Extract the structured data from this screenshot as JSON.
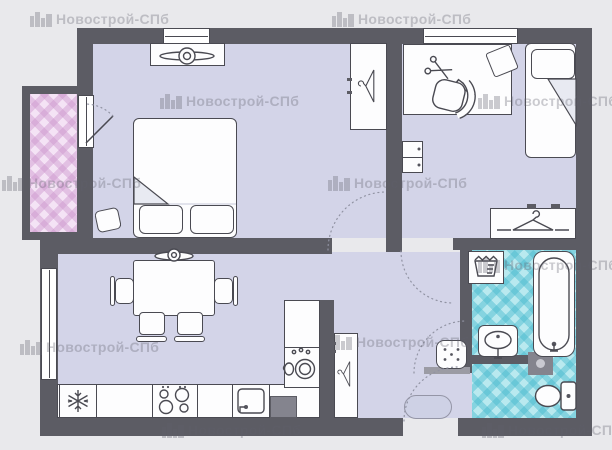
{
  "watermark": {
    "label": "Новострой-СПб",
    "icon": "buildings-icon",
    "positions": [
      {
        "x": 30,
        "y": 10
      },
      {
        "x": 332,
        "y": 10
      },
      {
        "x": 160,
        "y": 92
      },
      {
        "x": 478,
        "y": 92
      },
      {
        "x": 2,
        "y": 174
      },
      {
        "x": 328,
        "y": 174
      },
      {
        "x": 478,
        "y": 256
      },
      {
        "x": 20,
        "y": 338
      },
      {
        "x": 330,
        "y": 333
      },
      {
        "x": 162,
        "y": 421
      },
      {
        "x": 482,
        "y": 421
      }
    ]
  },
  "colors": {
    "background": "#e9e9ec",
    "wall": "#5c5c64",
    "floor": "#d3d4e8",
    "furniture_fill": "#fdfdfe",
    "furniture_line": "#4a4a52",
    "balcony_floor": "#f4e3f5",
    "balcony_diamond": "rgba(205,150,205,0.45)",
    "bathroom_floor": "#b9e9ef",
    "bathroom_diamond": "rgba(70,185,205,0.45)",
    "rug_fill": "#ced1e5",
    "shaft_fill": "#84848e",
    "watermark_color": "rgba(95,95,108,0.32)"
  }
}
